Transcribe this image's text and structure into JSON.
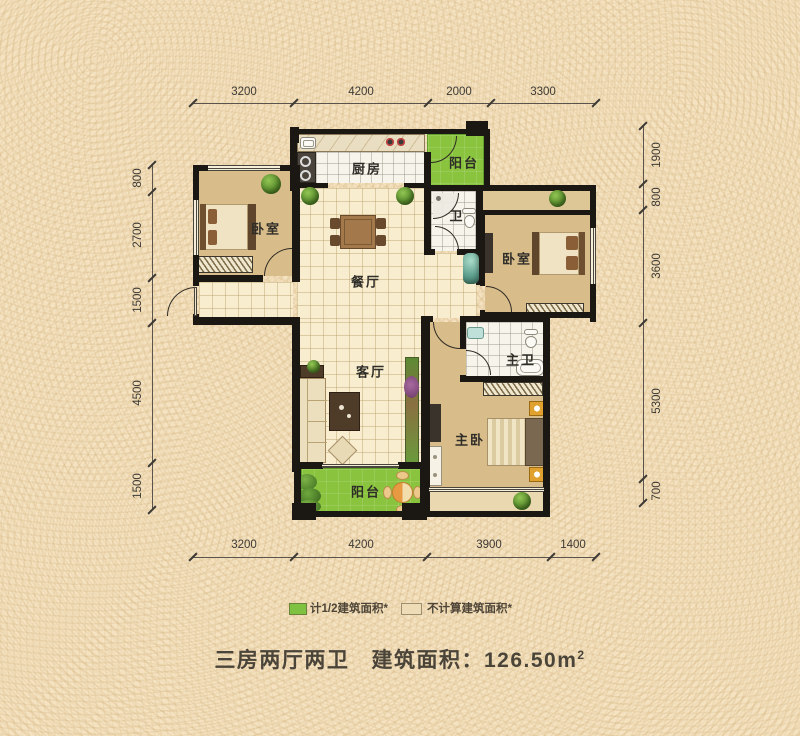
{
  "plan": {
    "rooms": {
      "kitchen": "厨房",
      "balcony_top": "阳台",
      "bedroom_left": "卧室",
      "dining": "餐厅",
      "bath": "卫",
      "bedroom_right": "卧室",
      "living": "客厅",
      "master_bath": "主卫",
      "master_bedroom": "主卧",
      "balcony_bottom": "阳台"
    },
    "dimensions": {
      "top": [
        "3200",
        "4200",
        "2000",
        "3300"
      ],
      "bottom": [
        "3200",
        "4200",
        "3900",
        "1400"
      ],
      "left": [
        "800",
        "2700",
        "1500",
        "4500",
        "1500"
      ],
      "right": [
        "1900",
        "800",
        "3600",
        "5300",
        "700"
      ]
    }
  },
  "legend": {
    "half_area": {
      "label": "计1/2建筑面积*",
      "color": "#7fc241"
    },
    "excluded_area": {
      "label": "不计算建筑面积*",
      "color": "#eedcb6"
    }
  },
  "footer": {
    "layout": "三房两厅两卫",
    "area_label": "建筑面积：126.50m",
    "area_sup": "2"
  },
  "colors": {
    "background": "#f4e2c0",
    "wall": "#1b1712",
    "floor_cream": "#f8eecf",
    "floor_tan": "#d8bc8a",
    "balcony_green": "#8ac43f",
    "tile_white": "#f7f4ec"
  }
}
